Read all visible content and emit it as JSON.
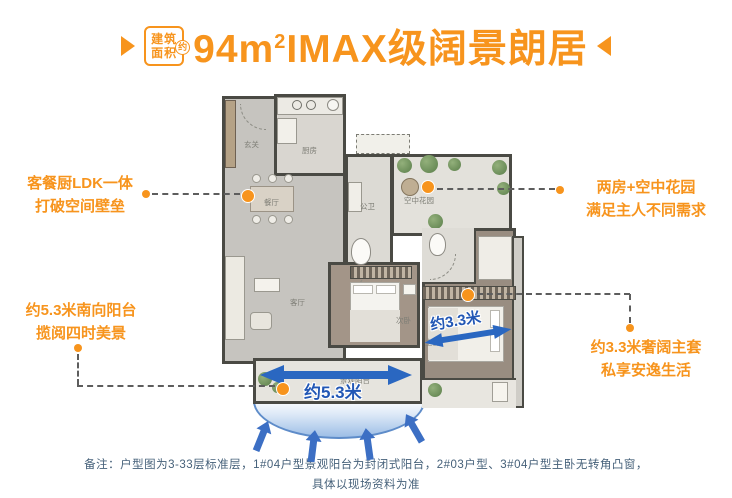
{
  "title": {
    "badge": {
      "line1": "建筑",
      "line2": "面积",
      "approx": "约"
    },
    "area_number": "94",
    "area_unit_base": "m",
    "area_unit_sup": "2",
    "headline": "IMAX级阔景朗居"
  },
  "callouts": {
    "left_top": {
      "line1": "客餐厨LDK一体",
      "line2": "打破空间壁垒"
    },
    "left_bottom": {
      "line1": "约5.3米南向阳台",
      "line2": "揽阅四时美景"
    },
    "right_top": {
      "line1": "两房+空中花园",
      "line2": "满足主人不同需求"
    },
    "right_bottom": {
      "line1": "约3.3米奢阔主套",
      "line2": "私享安逸生活"
    }
  },
  "floorplan": {
    "labels": {
      "entry": "玄关",
      "kitchen": "厨房",
      "dining": "餐厅",
      "bath": "公卫",
      "sky_garden": "空中花园",
      "living": "客厅",
      "bedroom2": "次卧",
      "master": "主卧",
      "balcony": "景观阳台"
    },
    "measure_balcony": "约5.3米",
    "measure_master": "约3.3米"
  },
  "note": {
    "line1": "备注：户型图为3-33层标准层，1#04户型景观阳台为封闭式阳台，2#03户型、3#04户型主卧无转角凸窗，",
    "line2": "具体以现场资料为准"
  },
  "colors": {
    "accent_orange": "#F7941D",
    "measure_blue": "#2A67C1",
    "note_text": "#46617A"
  },
  "icons": {
    "left_triangle": "right-pointing-triangle",
    "right_triangle": "left-pointing-triangle",
    "view_arrows": "up-arrow"
  }
}
